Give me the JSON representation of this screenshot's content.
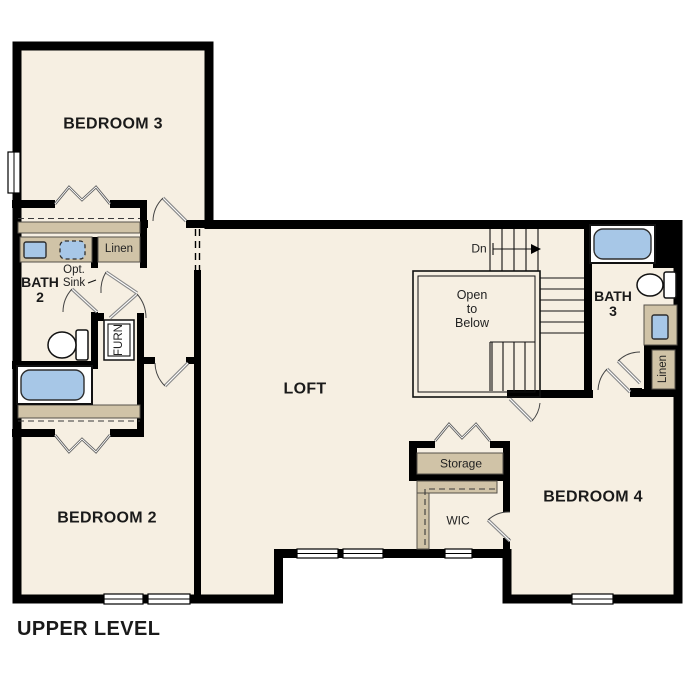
{
  "title": "UPPER LEVEL",
  "colors": {
    "floor": "#f6efe2",
    "wall": "#000000",
    "closet_tan": "#d0c3a7",
    "fixture_blue": "#a7c7e7",
    "door_gray": "#8a8a8a",
    "text": "#1a1a1a"
  },
  "labels": {
    "bedroom3": "BEDROOM 3",
    "bedroom2": "BEDROOM 2",
    "bedroom4": "BEDROOM 4",
    "loft": "LOFT",
    "bath2_line1": "BATH",
    "bath2_line2": "2",
    "bath3_line1": "BATH",
    "bath3_line2": "3",
    "open_line1": "Open",
    "open_line2": "to",
    "open_line3": "Below",
    "dn": "Dn",
    "linen_bath2": "Linen",
    "linen_bath3": "Linen",
    "furnace": "FURN",
    "opt_sink_line1": "Opt.",
    "opt_sink_line2": "Sink",
    "storage": "Storage",
    "wic": "WIC"
  },
  "fixtures": [
    "bathtub",
    "bathtub",
    "toilet",
    "toilet",
    "sink",
    "optional-sink",
    "vanity-sink",
    "furnace"
  ],
  "plan_features": [
    "stair-down",
    "open-to-below-railing",
    "cased-opening",
    "closet-rods",
    "bifold-doors",
    "windows"
  ]
}
